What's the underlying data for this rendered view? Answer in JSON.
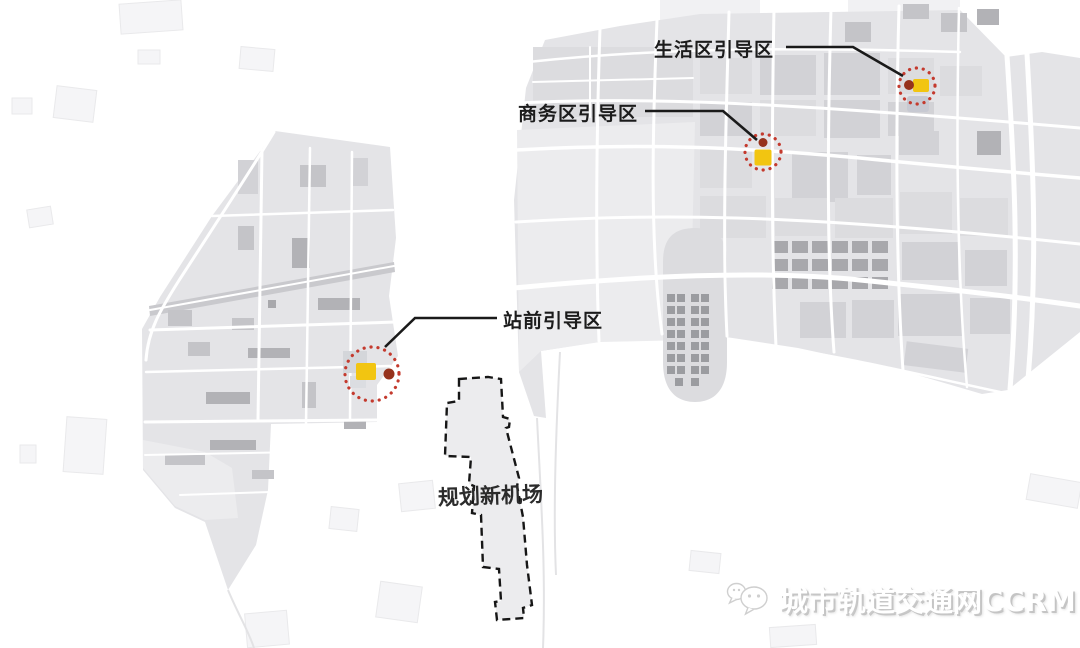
{
  "title": "城市轨道交通规划示意图",
  "map": {
    "callouts": [
      {
        "id": "living-area",
        "label": "生活区引导区"
      },
      {
        "id": "business-area",
        "label": "商务区引导区"
      },
      {
        "id": "station-front",
        "label": "站前引导区"
      }
    ],
    "airport_label": "规划新机场"
  },
  "watermark": {
    "text": "城市轨道交通网CCRM",
    "icon": "wechat-icon"
  },
  "colors": {
    "marker_circle": "#c43a2e",
    "marker_dot": "#96321c",
    "marker_square": "#f2c511",
    "callout_line": "#1a1a1a",
    "label_color": "#1c1c1c",
    "airport_fill": "#ececee",
    "airport_stroke": "#161616",
    "map_base": "#e4e4e7",
    "map_block": "#d2d2d6",
    "map_block_dark": "#a8a8ac",
    "road": "#ffffff"
  }
}
